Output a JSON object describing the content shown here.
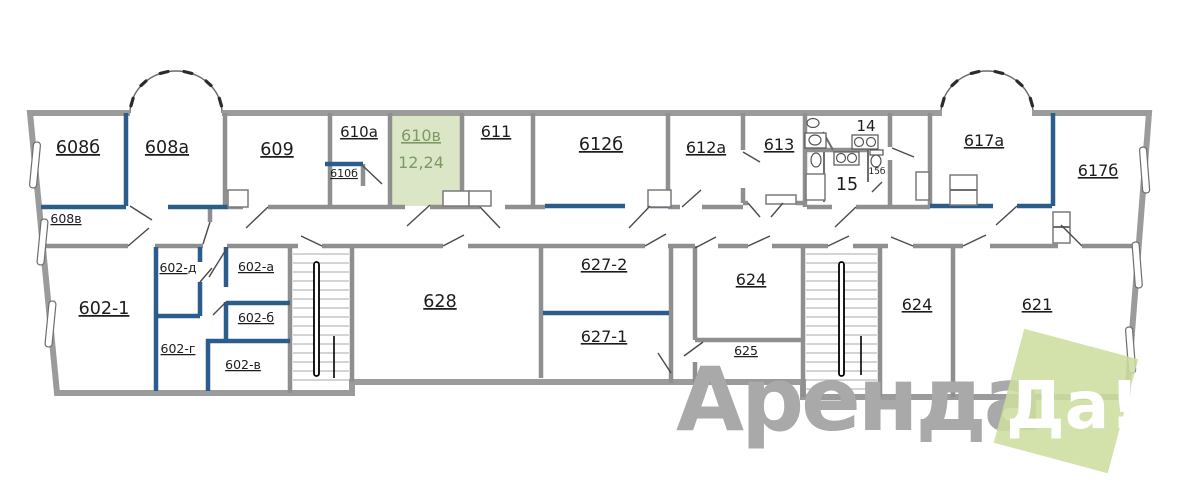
{
  "highlight": {
    "room": "610в",
    "area": "12,24"
  },
  "rooms": {
    "r608b": "608б",
    "r608a": "608а",
    "r608v": "608в",
    "r609": "609",
    "r610a": "610а",
    "r610bm": "610б",
    "r611": "611",
    "r612b": "612б",
    "r612a": "612а",
    "r613": "613",
    "r14": "14",
    "r15": "15",
    "r15b": "15б",
    "r617a": "617а",
    "r617b": "617б",
    "r602_1": "602-1",
    "r602d": "602-д",
    "r602a": "602-а",
    "r602b": "602-б",
    "r602g": "602-г",
    "r602v": "602-в",
    "r628": "628",
    "r627_2": "627-2",
    "r627_1": "627-1",
    "r624_1": "624",
    "r625": "625",
    "r624_2": "624",
    "r621": "621"
  },
  "watermark": {
    "brand_first": "Аренда",
    "brand_second": "Да!"
  },
  "colors": {
    "highlight_fill": "#dbe6c6",
    "highlight_text": "#7d9a64",
    "wall_gray": "#9b9b9b",
    "wall_blue": "#2b5d8c",
    "watermark_text": "#a9a9a9",
    "watermark_badge": "#cddc9e"
  }
}
